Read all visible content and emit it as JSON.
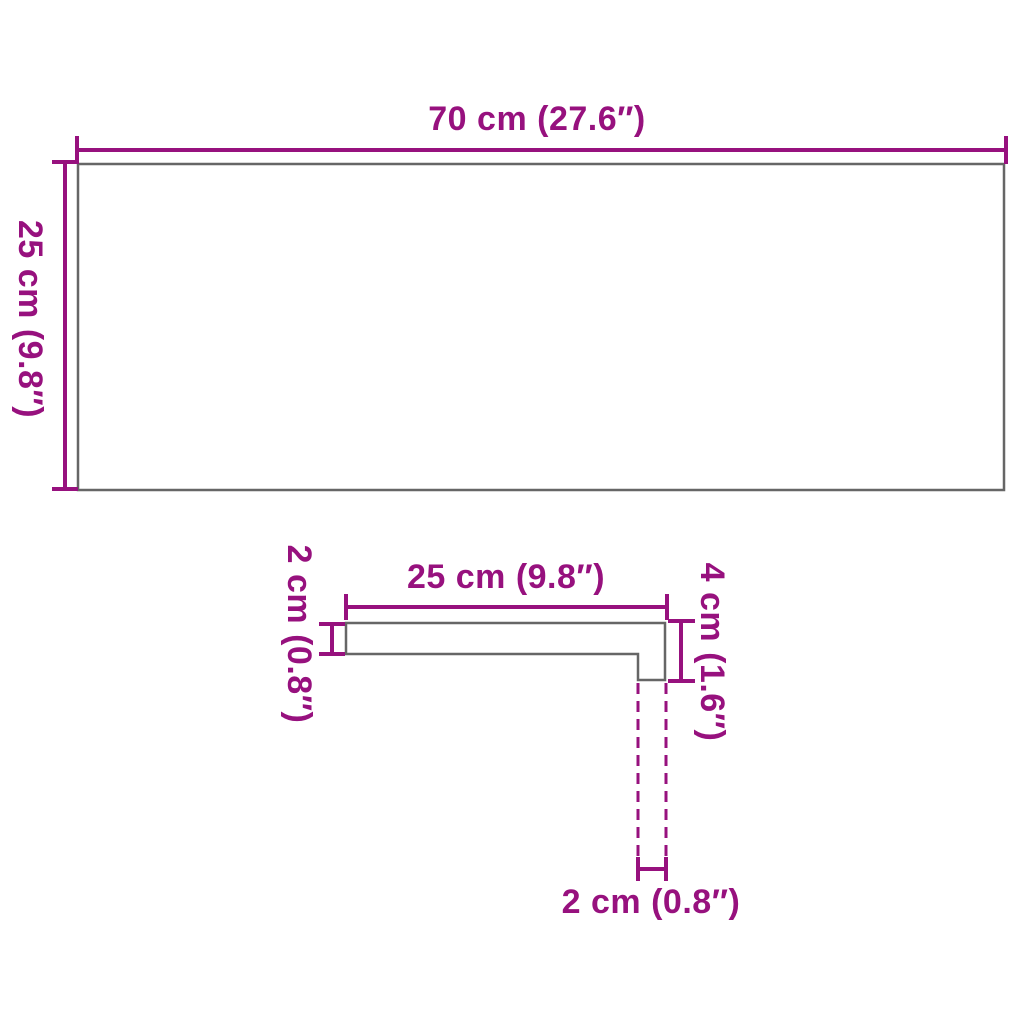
{
  "colors": {
    "dimension": "#97117E",
    "outline": "#666666",
    "background": "#FFFFFF"
  },
  "top_view": {
    "width_label": "70 cm (27.6″)",
    "height_label": "25 cm (9.8″)"
  },
  "profile_view": {
    "width_label": "25 cm (9.8″)",
    "thickness_label": "2 cm (0.8″)",
    "edge_height_label": "4 cm (1.6″)",
    "edge_thickness_label": "2 cm (0.8″)"
  }
}
